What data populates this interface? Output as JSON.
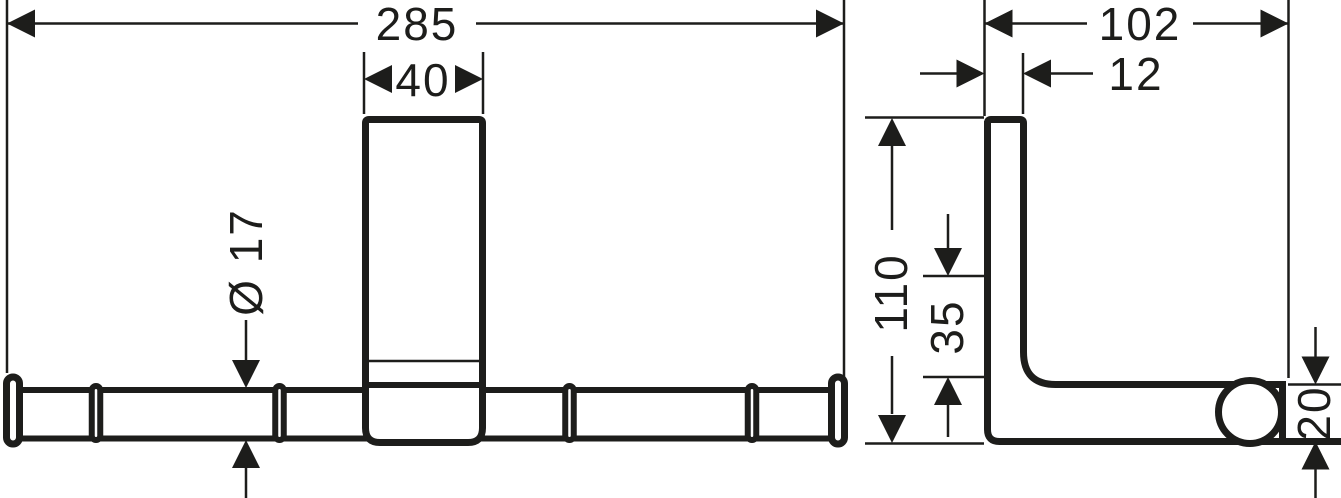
{
  "drawing": {
    "type": "technical-dimension-drawing",
    "background": "#ffffff",
    "ink": "#1d1d1b",
    "views": {
      "front": {
        "label": "front-view",
        "dimensions": {
          "overall_width": "285",
          "bracket_width": "40",
          "bar_diameter": "Ø 17"
        }
      },
      "side": {
        "label": "side-view",
        "dimensions": {
          "depth": "102",
          "plate_thickness": "12",
          "height": "110",
          "lower_offset": "35",
          "bar_size": "20"
        }
      }
    }
  }
}
